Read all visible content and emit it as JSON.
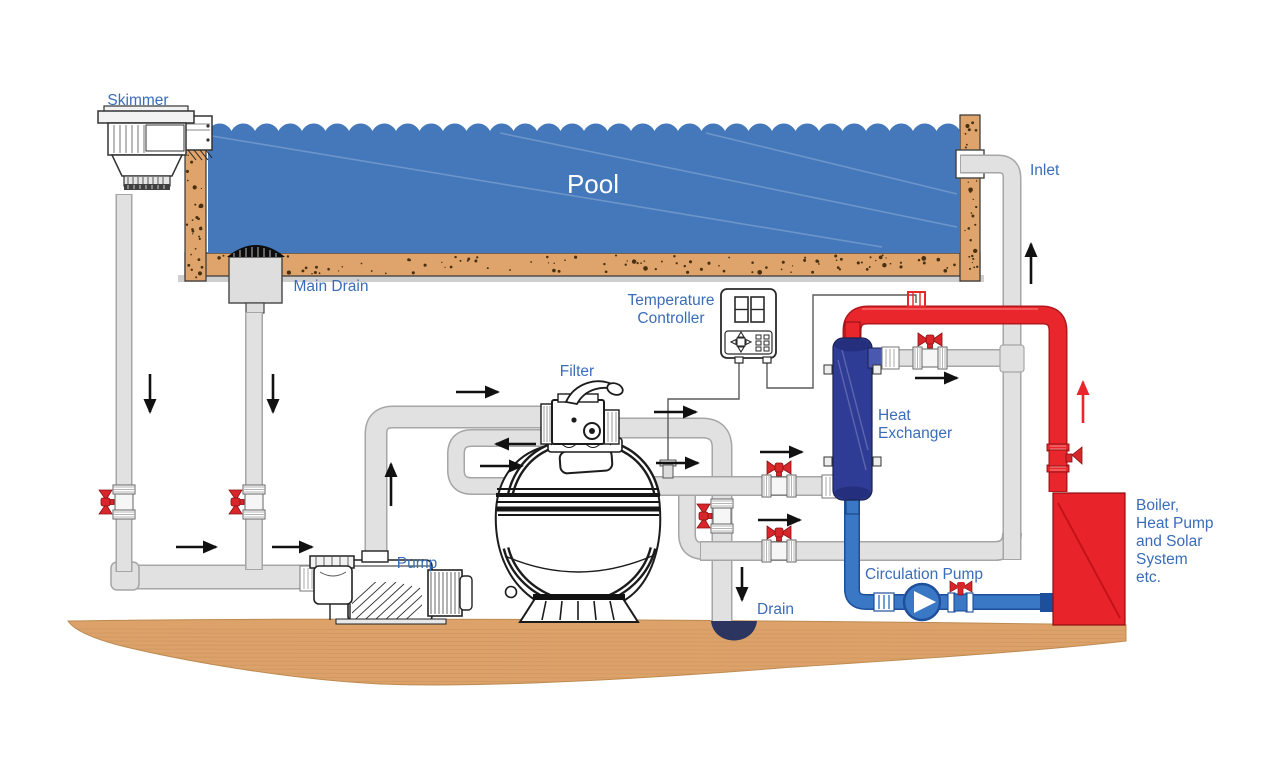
{
  "labels": {
    "skimmer": "Skimmer",
    "pool": "Pool",
    "main_drain": "Main Drain",
    "inlet": "Inlet",
    "temperature_controller": [
      "Temperature",
      "Controller"
    ],
    "filter": "Filter",
    "heat_exchanger": [
      "Heat",
      "Exchanger"
    ],
    "pump": "Pump",
    "circulation_pump": "Circulation Pump",
    "drain": "Drain",
    "boiler": [
      "Boiler,",
      "Heat Pump",
      "and Solar",
      "System",
      "etc."
    ]
  },
  "colors": {
    "pool_water": "#4478ba",
    "pool_wall_tan": "#dfa46c",
    "speckle": "#49300f",
    "ground_wood": "#dca26a",
    "ground_grain": "#c9945c",
    "pipe_gray": "#e1e1e1",
    "pipe_edge_gray": "#a6a6a6",
    "hot_pipe_red": "#e8262b",
    "hot_pipe_edge": "#b0181c",
    "cold_pipe_blue": "#3a77c5",
    "cold_pipe_edge": "#1d4f9b",
    "heat_exchanger_navy": "#2e3c96",
    "boiler_red": "#e8232a",
    "valve_handle_red": "#d8262b",
    "label_blue": "#3a6db8",
    "pool_text_white": "#ffffff",
    "arrow_black": "#111111"
  }
}
